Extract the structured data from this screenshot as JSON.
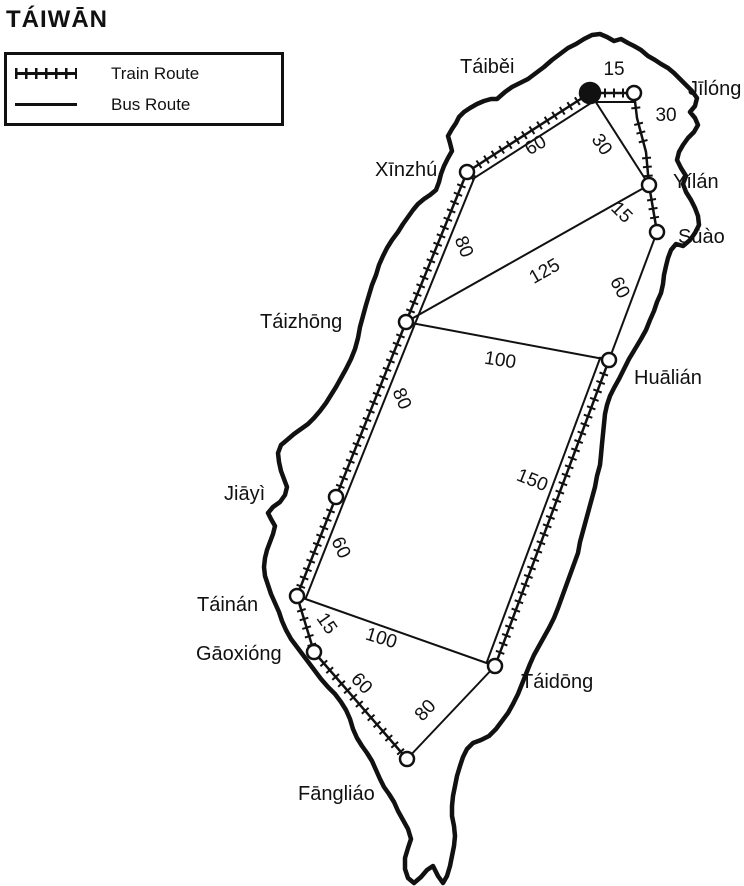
{
  "title": "TÁIWĀN",
  "legend": {
    "train_label": "Train Route",
    "bus_label": "Bus Route"
  },
  "colors": {
    "ink": "#111111",
    "paper": "#ffffff"
  },
  "map": {
    "nodes": [
      {
        "id": "taibei",
        "label": "Táiběi",
        "x": 590,
        "y": 93,
        "r": 10,
        "marker": "filled",
        "label_x": 460,
        "label_y": 73
      },
      {
        "id": "jilong",
        "label": "Jīlóng",
        "x": 634,
        "y": 93,
        "r": 7,
        "marker": "open",
        "label_x": 688,
        "label_y": 95
      },
      {
        "id": "yilan",
        "label": "Yílán",
        "x": 649,
        "y": 185,
        "r": 7,
        "marker": "open",
        "label_x": 673,
        "label_y": 188
      },
      {
        "id": "suao",
        "label": "Sūào",
        "x": 657,
        "y": 232,
        "r": 7,
        "marker": "open",
        "label_x": 678,
        "label_y": 243
      },
      {
        "id": "xinzhu",
        "label": "Xīnzhú",
        "x": 467,
        "y": 172,
        "r": 7,
        "marker": "open",
        "label_x": 375,
        "label_y": 176
      },
      {
        "id": "taizhong",
        "label": "Táizhōng",
        "x": 406,
        "y": 322,
        "r": 7,
        "marker": "open",
        "label_x": 260,
        "label_y": 328
      },
      {
        "id": "hualian",
        "label": "Huālián",
        "x": 609,
        "y": 360,
        "r": 7,
        "marker": "open",
        "label_x": 634,
        "label_y": 384
      },
      {
        "id": "jiayi",
        "label": "Jiāyì",
        "x": 336,
        "y": 497,
        "r": 7,
        "marker": "open",
        "label_x": 224,
        "label_y": 500
      },
      {
        "id": "tainan",
        "label": "Táinán",
        "x": 297,
        "y": 596,
        "r": 7,
        "marker": "open",
        "label_x": 197,
        "label_y": 611
      },
      {
        "id": "gaoxiong",
        "label": "Gāoxióng",
        "x": 314,
        "y": 652,
        "r": 7,
        "marker": "open",
        "label_x": 196,
        "label_y": 660
      },
      {
        "id": "fangliao",
        "label": "Fāngliáo",
        "x": 407,
        "y": 759,
        "r": 7,
        "marker": "open",
        "label_x": 298,
        "label_y": 800
      },
      {
        "id": "taidong",
        "label": "Táidōng",
        "x": 495,
        "y": 666,
        "r": 7,
        "marker": "open",
        "label_x": 521,
        "label_y": 688
      }
    ],
    "edges": [
      {
        "from": "taibei",
        "to": "jilong",
        "type": "train",
        "bus_parallel": true,
        "bus_offset": -9,
        "label": "15",
        "label_x": 614,
        "label_y": 70,
        "label_rot": 0
      },
      {
        "from": "jilong",
        "to": "yilan",
        "type": "train",
        "bus_parallel": false,
        "via": [
          [
            637,
            118
          ],
          [
            646,
            152
          ]
        ],
        "label": "30",
        "label_x": 666,
        "label_y": 116,
        "label_rot": 0
      },
      {
        "from": "yilan",
        "to": "suao",
        "type": "train",
        "bus_parallel": false,
        "label": "15",
        "label_x": 621,
        "label_y": 213,
        "label_rot": 45
      },
      {
        "from": "taibei",
        "to": "xinzhu",
        "type": "train",
        "bus_parallel": true,
        "bus_offset": 9,
        "label": "60",
        "label_x": 536,
        "label_y": 146,
        "label_rot": -30
      },
      {
        "from": "xinzhu",
        "to": "taizhong",
        "type": "train",
        "bus_parallel": true,
        "bus_offset": 9,
        "label": "80",
        "label_x": 463,
        "label_y": 247,
        "label_rot": 68
      },
      {
        "from": "taizhong",
        "to": "jiayi",
        "type": "train",
        "bus_parallel": true,
        "bus_offset": 9,
        "label": "80",
        "label_x": 401,
        "label_y": 399,
        "label_rot": 67
      },
      {
        "from": "jiayi",
        "to": "tainan",
        "type": "train",
        "bus_parallel": true,
        "bus_offset": 9,
        "label": "60",
        "label_x": 340,
        "label_y": 548,
        "label_rot": 65
      },
      {
        "from": "tainan",
        "to": "gaoxiong",
        "type": "train",
        "bus_parallel": false,
        "label": "15",
        "label_x": 326,
        "label_y": 624,
        "label_rot": 55
      },
      {
        "from": "gaoxiong",
        "to": "fangliao",
        "type": "train",
        "bus_parallel": false,
        "label": "60",
        "label_x": 361,
        "label_y": 684,
        "label_rot": 46
      },
      {
        "from": "hualian",
        "to": "taidong",
        "type": "train",
        "bus_parallel": true,
        "bus_offset": -9,
        "label": "150",
        "label_x": 532,
        "label_y": 481,
        "label_rot": 22
      },
      {
        "from": "taibei",
        "to": "yilan",
        "type": "bus",
        "bus_parallel": false,
        "label": "30",
        "label_x": 601,
        "label_y": 145,
        "label_rot": 55
      },
      {
        "from": "taizhong",
        "to": "yilan",
        "type": "bus",
        "bus_parallel": false,
        "label": "125",
        "label_x": 545,
        "label_y": 272,
        "label_rot": -30
      },
      {
        "from": "suao",
        "to": "hualian",
        "type": "bus",
        "bus_parallel": false,
        "label": "60",
        "label_x": 619,
        "label_y": 288,
        "label_rot": 62
      },
      {
        "from": "taizhong",
        "to": "hualian",
        "type": "bus",
        "bus_parallel": false,
        "label": "100",
        "label_x": 500,
        "label_y": 361,
        "label_rot": 9
      },
      {
        "from": "tainan",
        "to": "taidong",
        "type": "bus",
        "bus_parallel": false,
        "label": "100",
        "label_x": 381,
        "label_y": 639,
        "label_rot": 17
      },
      {
        "from": "fangliao",
        "to": "taidong",
        "type": "bus",
        "bus_parallel": false,
        "label": "80",
        "label_x": 426,
        "label_y": 711,
        "label_rot": -47
      }
    ],
    "outline": [
      [
        497,
        99
      ],
      [
        505,
        92
      ],
      [
        512,
        87
      ],
      [
        520,
        83
      ],
      [
        528,
        79
      ],
      [
        536,
        73
      ],
      [
        544,
        67
      ],
      [
        552,
        60
      ],
      [
        560,
        54
      ],
      [
        568,
        48
      ],
      [
        576,
        44
      ],
      [
        584,
        39
      ],
      [
        592,
        35
      ],
      [
        600,
        34
      ],
      [
        607,
        37
      ],
      [
        614,
        41
      ],
      [
        621,
        39
      ],
      [
        628,
        43
      ],
      [
        634,
        46
      ],
      [
        641,
        50
      ],
      [
        648,
        56
      ],
      [
        655,
        60
      ],
      [
        661,
        64
      ],
      [
        668,
        68
      ],
      [
        674,
        73
      ],
      [
        680,
        79
      ],
      [
        686,
        85
      ],
      [
        692,
        91
      ],
      [
        697,
        98
      ],
      [
        695,
        106
      ],
      [
        690,
        112
      ],
      [
        695,
        118
      ],
      [
        698,
        125
      ],
      [
        694,
        132
      ],
      [
        688,
        138
      ],
      [
        683,
        145
      ],
      [
        679,
        152
      ],
      [
        677,
        160
      ],
      [
        681,
        168
      ],
      [
        686,
        176
      ],
      [
        683,
        184
      ],
      [
        686,
        192
      ],
      [
        691,
        200
      ],
      [
        695,
        208
      ],
      [
        698,
        216
      ],
      [
        699,
        225
      ],
      [
        695,
        233
      ],
      [
        690,
        240
      ],
      [
        683,
        246
      ],
      [
        676,
        244
      ],
      [
        671,
        250
      ],
      [
        668,
        258
      ],
      [
        666,
        266
      ],
      [
        664,
        275
      ],
      [
        663,
        284
      ],
      [
        661,
        293
      ],
      [
        657,
        302
      ],
      [
        654,
        311
      ],
      [
        650,
        320
      ],
      [
        646,
        330
      ],
      [
        641,
        339
      ],
      [
        635,
        349
      ],
      [
        629,
        359
      ],
      [
        624,
        369
      ],
      [
        619,
        379
      ],
      [
        614,
        388
      ],
      [
        610,
        396
      ],
      [
        607,
        405
      ],
      [
        605,
        414
      ],
      [
        604,
        424
      ],
      [
        603,
        434
      ],
      [
        602,
        444
      ],
      [
        601,
        455
      ],
      [
        600,
        465
      ],
      [
        597,
        476
      ],
      [
        595,
        487
      ],
      [
        592,
        498
      ],
      [
        589,
        509
      ],
      [
        586,
        520
      ],
      [
        583,
        531
      ],
      [
        580,
        542
      ],
      [
        578,
        553
      ],
      [
        574,
        564
      ],
      [
        570,
        575
      ],
      [
        566,
        586
      ],
      [
        562,
        597
      ],
      [
        558,
        608
      ],
      [
        554,
        618
      ],
      [
        549,
        628
      ],
      [
        544,
        637
      ],
      [
        539,
        646
      ],
      [
        534,
        655
      ],
      [
        530,
        664
      ],
      [
        526,
        674
      ],
      [
        522,
        684
      ],
      [
        518,
        694
      ],
      [
        513,
        704
      ],
      [
        508,
        713
      ],
      [
        502,
        721
      ],
      [
        496,
        729
      ],
      [
        489,
        736
      ],
      [
        481,
        740
      ],
      [
        473,
        743
      ],
      [
        467,
        749
      ],
      [
        463,
        757
      ],
      [
        460,
        766
      ],
      [
        457,
        776
      ],
      [
        455,
        786
      ],
      [
        453,
        796
      ],
      [
        452,
        806
      ],
      [
        452,
        816
      ],
      [
        454,
        826
      ],
      [
        455,
        836
      ],
      [
        454,
        846
      ],
      [
        452,
        856
      ],
      [
        450,
        866
      ],
      [
        447,
        876
      ],
      [
        443,
        883
      ],
      [
        438,
        876
      ],
      [
        433,
        866
      ],
      [
        427,
        870
      ],
      [
        421,
        877
      ],
      [
        414,
        883
      ],
      [
        408,
        878
      ],
      [
        405,
        869
      ],
      [
        405,
        858
      ],
      [
        408,
        848
      ],
      [
        411,
        839
      ],
      [
        408,
        829
      ],
      [
        403,
        820
      ],
      [
        398,
        811
      ],
      [
        394,
        802
      ],
      [
        389,
        794
      ],
      [
        384,
        787
      ],
      [
        380,
        779
      ],
      [
        376,
        770
      ],
      [
        372,
        761
      ],
      [
        367,
        753
      ],
      [
        362,
        746
      ],
      [
        357,
        738
      ],
      [
        353,
        729
      ],
      [
        350,
        719
      ],
      [
        346,
        710
      ],
      [
        341,
        702
      ],
      [
        335,
        694
      ],
      [
        328,
        687
      ],
      [
        321,
        679
      ],
      [
        315,
        671
      ],
      [
        309,
        663
      ],
      [
        303,
        655
      ],
      [
        297,
        647
      ],
      [
        291,
        639
      ],
      [
        286,
        630
      ],
      [
        282,
        621
      ],
      [
        279,
        612
      ],
      [
        275,
        603
      ],
      [
        271,
        594
      ],
      [
        268,
        585
      ],
      [
        265,
        576
      ],
      [
        264,
        567
      ],
      [
        265,
        558
      ],
      [
        267,
        550
      ],
      [
        270,
        542
      ],
      [
        273,
        534
      ],
      [
        275,
        526
      ],
      [
        271,
        519
      ],
      [
        268,
        513
      ],
      [
        273,
        507
      ],
      [
        280,
        502
      ],
      [
        285,
        495
      ],
      [
        287,
        487
      ],
      [
        284,
        479
      ],
      [
        281,
        471
      ],
      [
        279,
        462
      ],
      [
        278,
        453
      ],
      [
        281,
        445
      ],
      [
        287,
        440
      ],
      [
        294,
        434
      ],
      [
        301,
        429
      ],
      [
        308,
        424
      ],
      [
        314,
        418
      ],
      [
        320,
        411
      ],
      [
        326,
        403
      ],
      [
        331,
        395
      ],
      [
        336,
        387
      ],
      [
        341,
        378
      ],
      [
        346,
        369
      ],
      [
        351,
        359
      ],
      [
        355,
        349
      ],
      [
        358,
        338
      ],
      [
        360,
        327
      ],
      [
        363,
        316
      ],
      [
        366,
        305
      ],
      [
        369,
        295
      ],
      [
        372,
        285
      ],
      [
        376,
        275
      ],
      [
        379,
        265
      ],
      [
        383,
        256
      ],
      [
        387,
        248
      ],
      [
        392,
        240
      ],
      [
        398,
        232
      ],
      [
        403,
        224
      ],
      [
        408,
        217
      ],
      [
        413,
        210
      ],
      [
        418,
        204
      ],
      [
        424,
        199
      ],
      [
        430,
        195
      ],
      [
        436,
        190
      ],
      [
        439,
        182
      ],
      [
        441,
        174
      ],
      [
        444,
        166
      ],
      [
        448,
        158
      ],
      [
        452,
        151
      ],
      [
        450,
        143
      ],
      [
        448,
        136
      ],
      [
        452,
        129
      ],
      [
        456,
        123
      ],
      [
        459,
        117
      ],
      [
        464,
        112
      ],
      [
        470,
        108
      ],
      [
        477,
        104
      ],
      [
        484,
        101
      ],
      [
        491,
        99
      ]
    ]
  }
}
